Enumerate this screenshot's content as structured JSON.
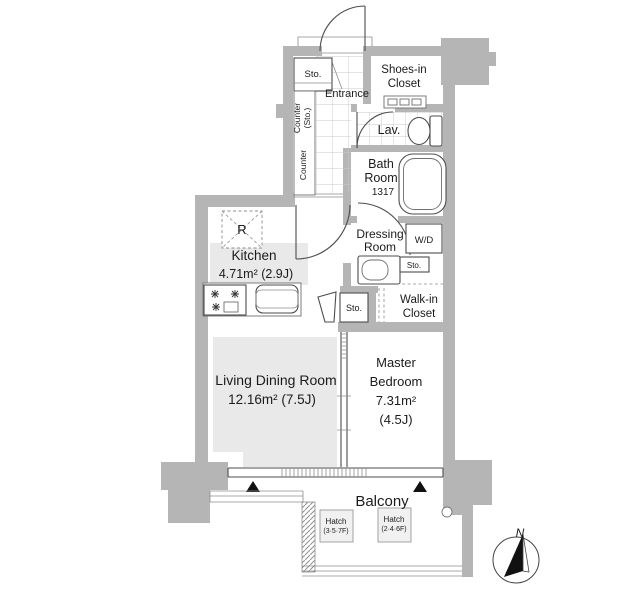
{
  "colors": {
    "wall": "#b5b5b5",
    "floor_shade": "#e9e9e9",
    "line": "#4a4a4a",
    "tile_line": "#c9c9c9"
  },
  "rooms": {
    "entrance": "Entrance",
    "shoes_closet": [
      "Shoes-in",
      "Closet"
    ],
    "lav": "Lav.",
    "bath": [
      "Bath",
      "Room",
      "1317"
    ],
    "dressing": [
      "Dressing",
      "Room"
    ],
    "wd": "W/D",
    "walk_in_closet": [
      "Walk-in",
      "Closet"
    ],
    "kitchen": {
      "name": "Kitchen",
      "size": "4.71m² (2.9J)"
    },
    "living": {
      "name": "Living Dining Room",
      "size": "12.16m² (7.5J)"
    },
    "bedroom": [
      "Master",
      "Bedroom",
      "7.31m²",
      "(4.5J)"
    ],
    "balcony": "Balcony"
  },
  "storage": {
    "entrance_sto": "Sto.",
    "counter_upper": [
      "Counter",
      "(Sto.)"
    ],
    "counter_lower": "Counter",
    "dressing_sto": "Sto.",
    "hall_sto": "Sto.",
    "refrigerator": "R"
  },
  "hatches": [
    {
      "label": "Hatch",
      "floors": "(3·5·7F)"
    },
    {
      "label": "Hatch",
      "floors": "(2·4·6F)"
    }
  ],
  "compass": {
    "north": "N"
  }
}
